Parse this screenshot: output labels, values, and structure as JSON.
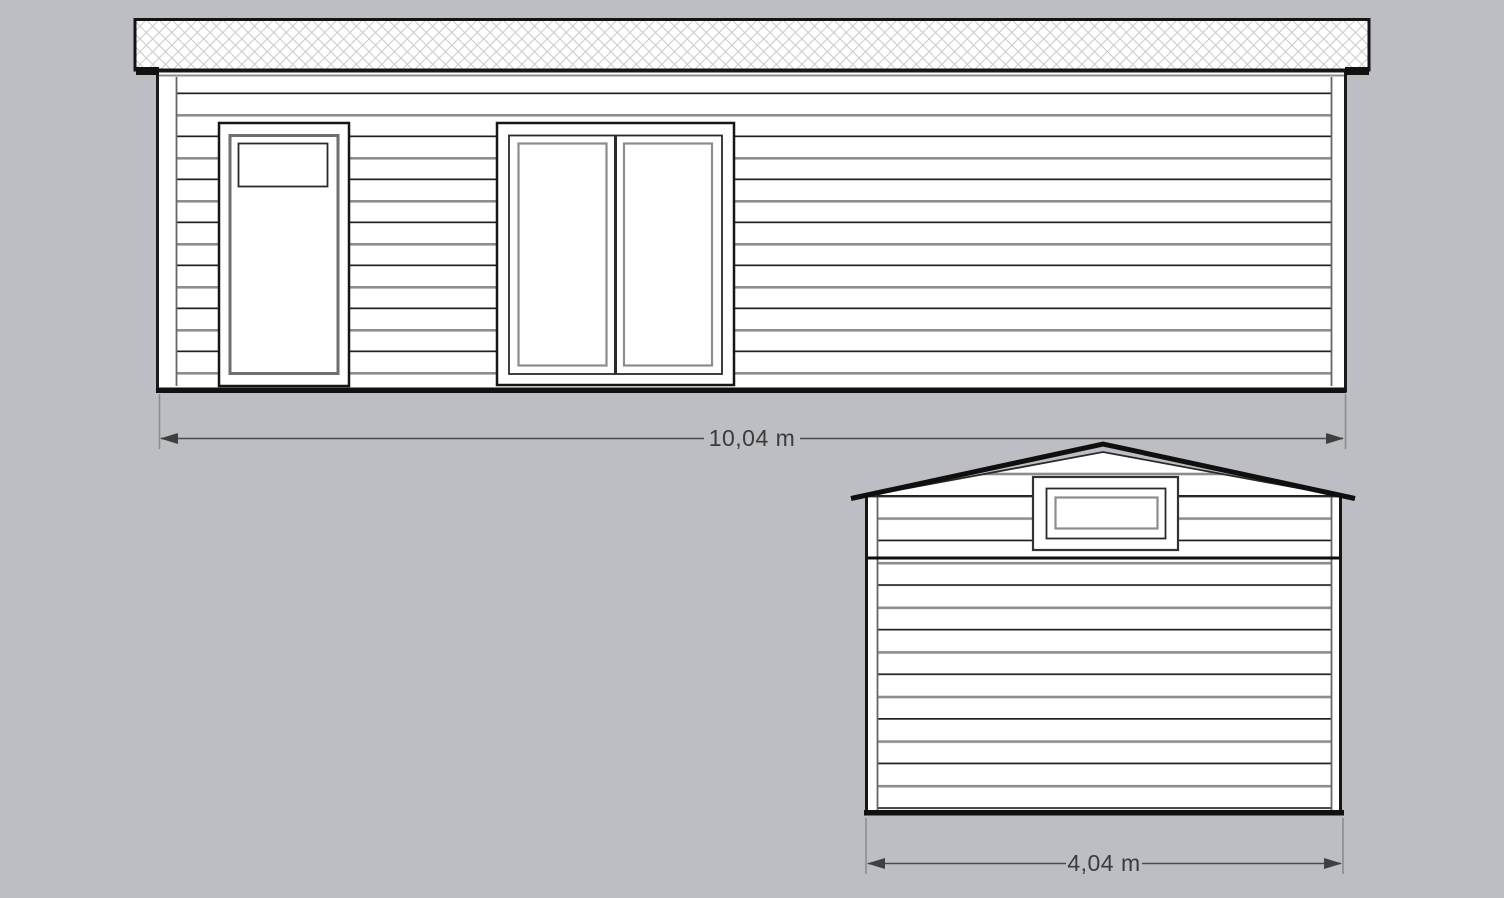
{
  "colors": {
    "background": "#bdbec3",
    "drawing_white": "#ffffff",
    "outline_black": "#161616",
    "siding_gray": "#8d8d8d",
    "hatch_gray": "#c9c9c9",
    "dimension_line_gray": "#4a4a4a",
    "dimension_text_gray": "#3b3b3b"
  },
  "dimensions": {
    "front_width": "10,04 m",
    "gable_width": "4,04 m"
  }
}
